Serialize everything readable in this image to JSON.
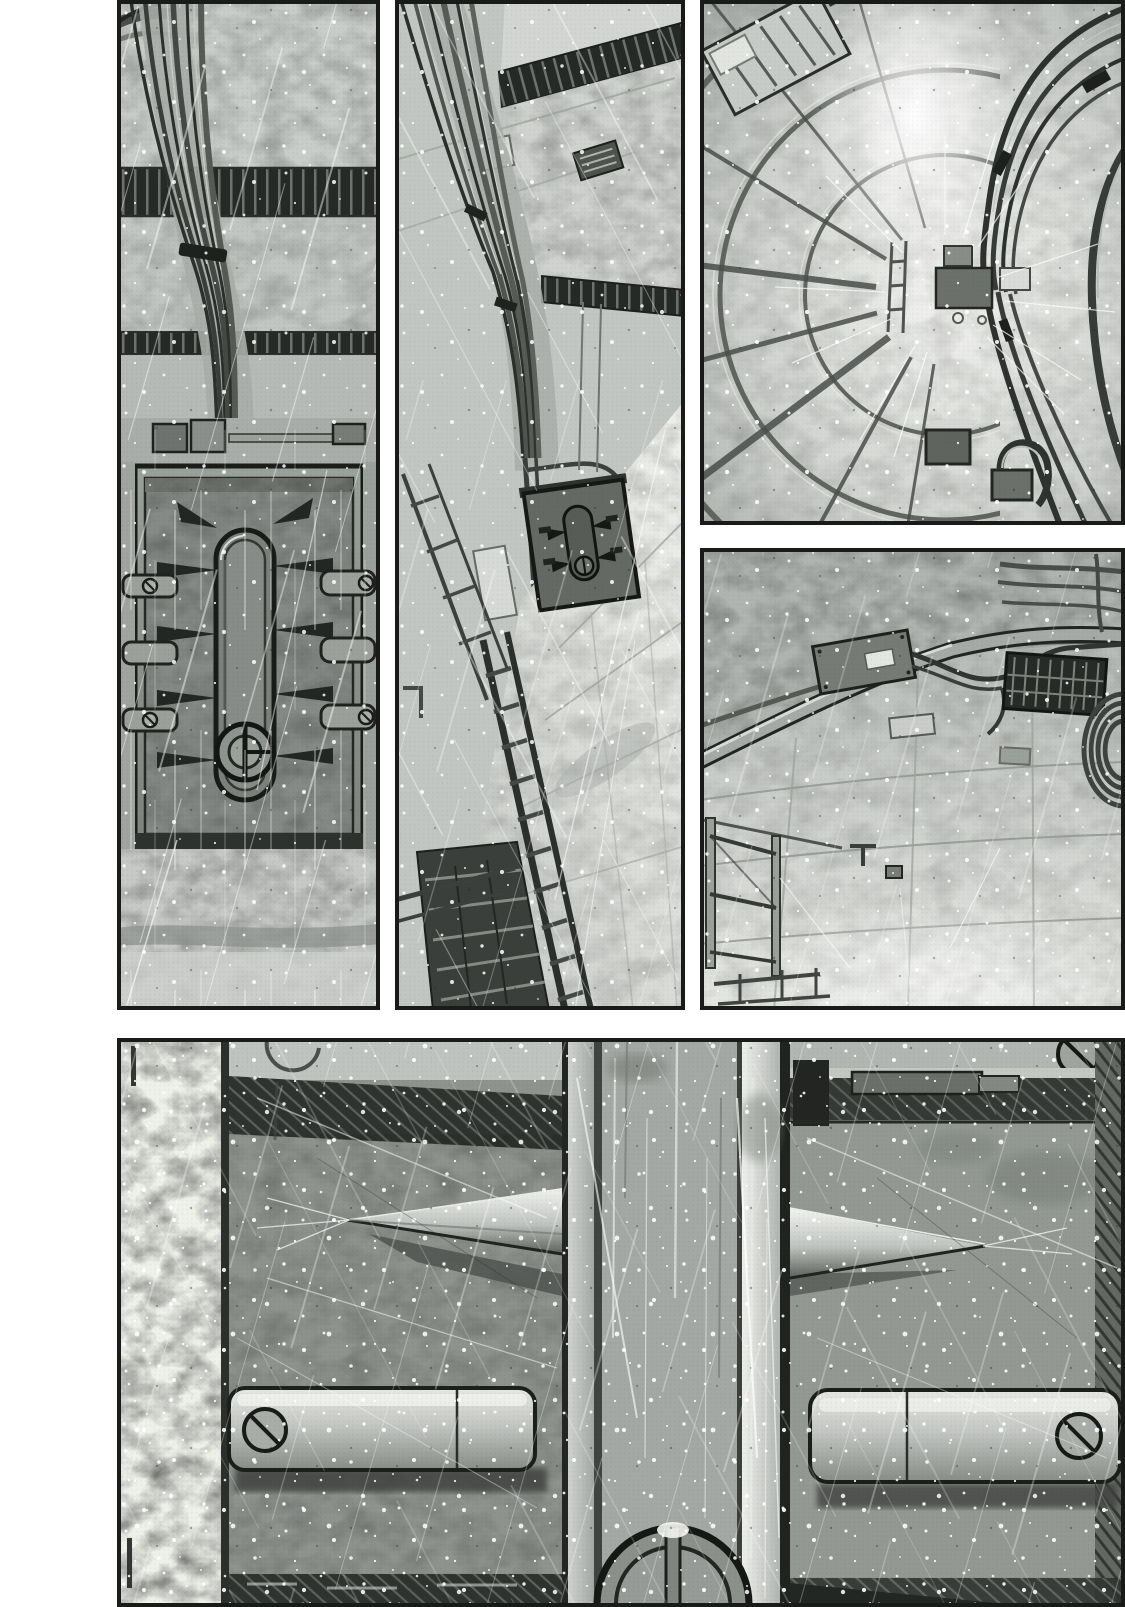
{
  "page": {
    "medium": "black-and-white manga page",
    "description": "Wordless black-and-white manga page of five panels showing the deserted interior of a large vessel: a sealed spiked hatch, a tilted cable-lined corridor, a ribbed tunnel shaft seen head-on, an empty tiled compartment, and a wide close-up of a massive door-locking mechanism. Spray streaks and white specks cover the artwork. No dialogue, captions or sound effects.",
    "text_content": []
  },
  "palette": {
    "paper": "#ffffff",
    "ink": "#191b19",
    "light_gray": "#d8dad6",
    "mid_gray": "#a8aca8",
    "dark_gray": "#4a4e4a",
    "shadow_black": "#232723"
  },
  "panels": [
    {
      "id": "panel-1",
      "title": "sealed hatch door",
      "description": "Tall left panel: a narrow bulkhead wall with a bundle of cables flowing down from ceiling beams past two dark shadow bands to a junction box, above a sealed rectangular hatch. The hatch carries an oblong locking rail with a small double-ring hand wheel and rows of spiked cleats and bolted brackets on both sides; bare mottled floor below."
    },
    {
      "id": "panel-2",
      "title": "tilted corridor",
      "description": "Tall middle panel: an empty corridor seen tilted from above; thick cable bundles sweep from the upper left along the ceiling, past striped shadow bands, toward a small closed hatch at the far end; a dark runged cable tray and railings descend the left side while bright floor plating fills the lower right."
    },
    {
      "id": "panel-3",
      "title": "tunnel shaft",
      "description": "Top right panel: wide-angle view straight down a ribbed circular shaft; structural ribs and ring frames radiate on the left, cable bundles curve in from the upper right toward small fittings and boxes at the glowing vanishing point, then fan out toward the lower edge."
    },
    {
      "id": "panel-4",
      "title": "empty compartment",
      "description": "Right middle panel: a bare tiled compartment viewed from a high corner; a curved conduit and junction box cross the ceiling, cables snake to the right, a dark slatted grate and a coiled hose hug the right wall, thin railings stand on the left, and the seamed tile floor brightens toward the bottom."
    },
    {
      "id": "panel-5",
      "title": "door locking mechanism close-up",
      "description": "Wide bottom panel: extreme close-up of a huge lock mechanism; a bright central guide column divides two recessed plates, each holding an outward-pointing conical latch pin and a long capsule-shaped sliding bolt fixed by a slotted screw head; hatched shadow beams run along the top, the spoked top of a hand wheel rises from the bottom edge, and a weathered white jamb borders the left."
    }
  ],
  "effects": {
    "speed_line_streaks": true,
    "spray_particles": true,
    "halftone_grain": true,
    "dialogue": "none",
    "captions": "none",
    "sound_effects": "none"
  }
}
